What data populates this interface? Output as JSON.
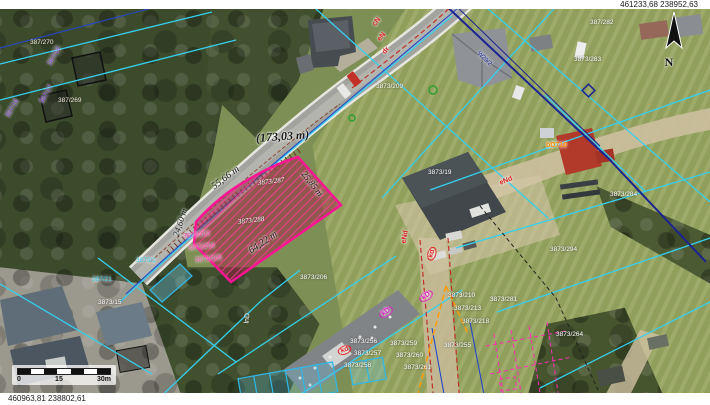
{
  "window": {
    "coords_top_right": "461233,68  238952,63",
    "coords_bottom_left": "460963,81  238802,61"
  },
  "compass": {
    "label": "N"
  },
  "scale_bar": {
    "labels": [
      "0",
      "15",
      "30m"
    ]
  },
  "selected_parcel": {
    "outline_color": "#ff1493",
    "numbers": [
      "3873/287",
      "3873/288"
    ],
    "dimensions": [
      "(173,03 m)",
      "55,66 m",
      "25,85 m",
      "64,22 m",
      "24,60 m"
    ]
  },
  "colors": {
    "parcel_line_cyan": "#35d0ee",
    "parcel_line_blue": "#2448c8",
    "utility_red": "#e02020",
    "highlight_magenta": "#ff1493"
  },
  "map_labels": [
    {
      "t": "(173,03 m)",
      "x": 256,
      "y": 132,
      "r": -4,
      "c": "#1a1a1a",
      "s": 12,
      "i": 1,
      "b": 1
    },
    {
      "t": "55,66 m",
      "x": 213,
      "y": 183,
      "r": -37,
      "c": "#1a1a1a",
      "s": 10,
      "i": 1
    },
    {
      "t": "25,85 m",
      "x": 303,
      "y": 168,
      "r": 52,
      "c": "#1a1a1a",
      "s": 9,
      "i": 1
    },
    {
      "t": "64,22 m",
      "x": 250,
      "y": 247,
      "r": -34,
      "c": "#1a1a1a",
      "s": 10,
      "i": 1
    },
    {
      "t": "24,60 m",
      "x": 176,
      "y": 232,
      "r": -72,
      "c": "#1a1a1a",
      "s": 9,
      "i": 1
    },
    {
      "t": "3873/287",
      "x": 258,
      "y": 180,
      "r": -7,
      "c": "#fff",
      "s": 7,
      "i": 1
    },
    {
      "t": "3873/288",
      "x": 238,
      "y": 219,
      "r": -7,
      "c": "#fff",
      "s": 7,
      "i": 1
    },
    {
      "t": "3873/203",
      "x": 183,
      "y": 234,
      "r": -6,
      "c": "#f040a8",
      "s": 6.5
    },
    {
      "t": "3873/204",
      "x": 188,
      "y": 246,
      "r": -6,
      "c": "#f040a8",
      "s": 6.5
    },
    {
      "t": "3873/205",
      "x": 195,
      "y": 258,
      "r": -6,
      "c": "#f040a8",
      "s": 6.5
    },
    {
      "t": "3873/206",
      "x": 300,
      "y": 275,
      "r": 0,
      "c": "#fff",
      "s": 6.5
    },
    {
      "t": "3873/209",
      "x": 376,
      "y": 84,
      "r": 0,
      "c": "#fff",
      "s": 6.5
    },
    {
      "t": "387/282",
      "x": 590,
      "y": 20,
      "r": 0,
      "c": "#fff",
      "s": 6.5
    },
    {
      "t": "3873/283",
      "x": 574,
      "y": 57,
      "r": 0,
      "c": "#fff",
      "s": 6.5
    },
    {
      "t": "3873/19",
      "x": 428,
      "y": 170,
      "r": 0,
      "c": "#fff",
      "s": 6.5
    },
    {
      "t": "3873/284",
      "x": 610,
      "y": 192,
      "r": 0,
      "c": "#fff",
      "s": 6.5
    },
    {
      "t": "3873/294",
      "x": 550,
      "y": 247,
      "r": 0,
      "c": "#fff",
      "s": 6.5
    },
    {
      "t": "3873/281",
      "x": 490,
      "y": 297,
      "r": 0,
      "c": "#fff",
      "s": 6.5
    },
    {
      "t": "3873/264",
      "x": 556,
      "y": 332,
      "r": 0,
      "c": "#fff",
      "s": 6.5
    },
    {
      "t": "3873/210",
      "x": 448,
      "y": 293,
      "r": 0,
      "c": "#fff",
      "s": 6.5
    },
    {
      "t": "3873/213",
      "x": 454,
      "y": 306,
      "r": 0,
      "c": "#fff",
      "s": 6.5
    },
    {
      "t": "3873/218",
      "x": 462,
      "y": 319,
      "r": 0,
      "c": "#fff",
      "s": 6.5
    },
    {
      "t": "3873/255",
      "x": 444,
      "y": 343,
      "r": 0,
      "c": "#fff",
      "s": 6.5
    },
    {
      "t": "3873/256",
      "x": 350,
      "y": 339,
      "r": 0,
      "c": "#fff",
      "s": 6.5
    },
    {
      "t": "3873/257",
      "x": 354,
      "y": 351,
      "r": 0,
      "c": "#fff",
      "s": 6.5
    },
    {
      "t": "3873/258",
      "x": 344,
      "y": 363,
      "r": 0,
      "c": "#fff",
      "s": 6.5
    },
    {
      "t": "3873/259",
      "x": 390,
      "y": 341,
      "r": 0,
      "c": "#fff",
      "s": 6.5
    },
    {
      "t": "3873/260",
      "x": 396,
      "y": 353,
      "r": 0,
      "c": "#fff",
      "s": 6.5
    },
    {
      "t": "3873/261",
      "x": 404,
      "y": 365,
      "r": 0,
      "c": "#fff",
      "s": 6.5
    },
    {
      "t": "3873/15",
      "x": 98,
      "y": 300,
      "r": 0,
      "c": "#fff",
      "s": 6.5
    },
    {
      "t": "387/270",
      "x": 30,
      "y": 40,
      "r": 0,
      "c": "#f0ead8",
      "s": 6.5
    },
    {
      "t": "387/269",
      "x": 58,
      "y": 98,
      "r": 0,
      "c": "#f0ead8",
      "s": 6.5
    },
    {
      "t": "lnD",
      "x": 247,
      "y": 320,
      "r": -85,
      "c": "#fff",
      "s": 7
    },
    {
      "t": "cN",
      "x": 374,
      "y": 22,
      "r": -52,
      "c": "#e02020",
      "s": 7,
      "b": 1
    },
    {
      "t": "eN",
      "x": 379,
      "y": 37,
      "r": -52,
      "c": "#e02020",
      "s": 7,
      "b": 1
    },
    {
      "t": "dr",
      "x": 384,
      "y": 50,
      "r": -52,
      "c": "#e02020",
      "s": 7,
      "b": 1
    },
    {
      "t": "eNd",
      "x": 500,
      "y": 180,
      "r": -22,
      "c": "#e02020",
      "s": 7,
      "b": 1
    },
    {
      "t": "eNd",
      "x": 404,
      "y": 240,
      "r": -80,
      "c": "#e02020",
      "s": 7,
      "b": 1
    },
    {
      "t": "kD",
      "x": 380,
      "y": 312,
      "r": -35,
      "c": "#e020c0",
      "s": 7,
      "b": 1,
      "box": 1
    },
    {
      "t": "kD",
      "x": 420,
      "y": 296,
      "r": -35,
      "c": "#e020c0",
      "s": 7,
      "b": 1,
      "box": 1
    },
    {
      "t": "kd",
      "x": 338,
      "y": 348,
      "r": -20,
      "c": "#e02020",
      "s": 7,
      "b": 1,
      "box": 1
    },
    {
      "t": "kd",
      "x": 430,
      "y": 256,
      "r": -75,
      "c": "#e02020",
      "s": 7,
      "b": 1,
      "box": 1
    },
    {
      "t": "jezd.",
      "x": 348,
      "y": 4,
      "r": -52,
      "c": "#00a8b0",
      "s": 6
    },
    {
      "t": "bD710",
      "x": 546,
      "y": 142,
      "r": 0,
      "c": "#ff8c00",
      "s": 7,
      "b": 1
    },
    {
      "t": "387/18",
      "x": 50,
      "y": 62,
      "r": -60,
      "c": "#8040d8",
      "s": 6.5
    },
    {
      "t": "387/17",
      "x": 42,
      "y": 100,
      "r": -60,
      "c": "#8040d8",
      "s": 6.5
    },
    {
      "t": "387/16",
      "x": 8,
      "y": 114,
      "r": -60,
      "c": "#8040d8",
      "s": 6.5
    },
    {
      "t": "W29/2",
      "x": 478,
      "y": 50,
      "r": 44,
      "c": "#1a2492",
      "s": 6
    },
    {
      "t": "387/21",
      "x": 92,
      "y": 277,
      "r": 0,
      "c": "#30c8e8",
      "s": 6.5
    },
    {
      "t": "3873/2",
      "x": 136,
      "y": 258,
      "r": 0,
      "c": "#30c8e8",
      "s": 6.5
    }
  ]
}
